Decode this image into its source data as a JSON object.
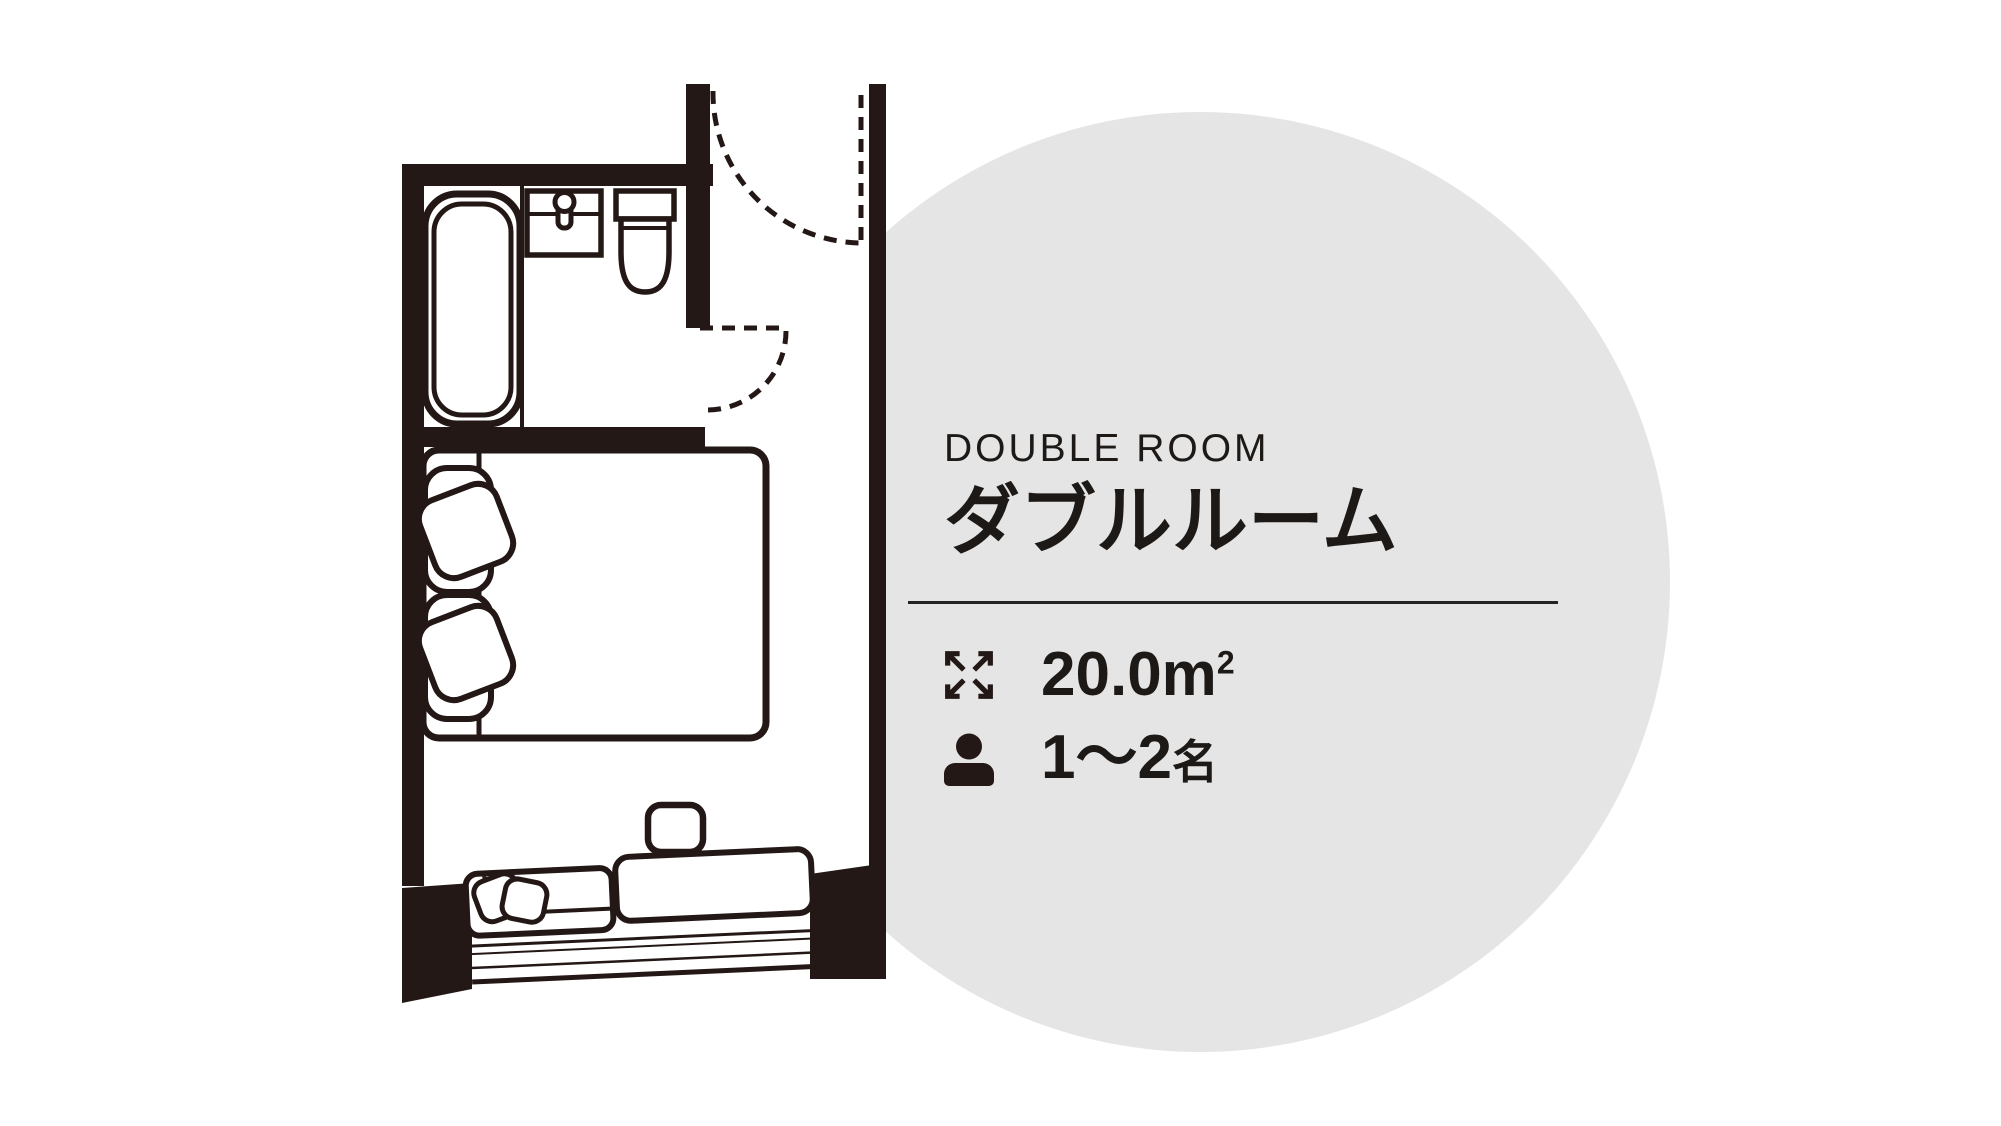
{
  "page": {
    "width": 2001,
    "height": 1126,
    "background": "#ffffff"
  },
  "accent_circle": {
    "color": "#e5e5e5"
  },
  "ink_color": "#231815",
  "room": {
    "name_en": "DOUBLE ROOM",
    "name_ja": "ダブルルーム",
    "area": {
      "value": "20.0",
      "unit_base": "m",
      "unit_exponent": "2",
      "display": "20.0㎡"
    },
    "capacity": {
      "range": "1〜2",
      "unit": "名",
      "display": "1〜2名"
    }
  },
  "floor_plan": {
    "fixtures": [
      "bathtub",
      "washbasin",
      "faucet",
      "toilet",
      "entrance-door-swing",
      "bathroom-door-swing",
      "double-bed",
      "pillows",
      "cushions",
      "side-table",
      "bench-sofa",
      "bay-window"
    ]
  }
}
